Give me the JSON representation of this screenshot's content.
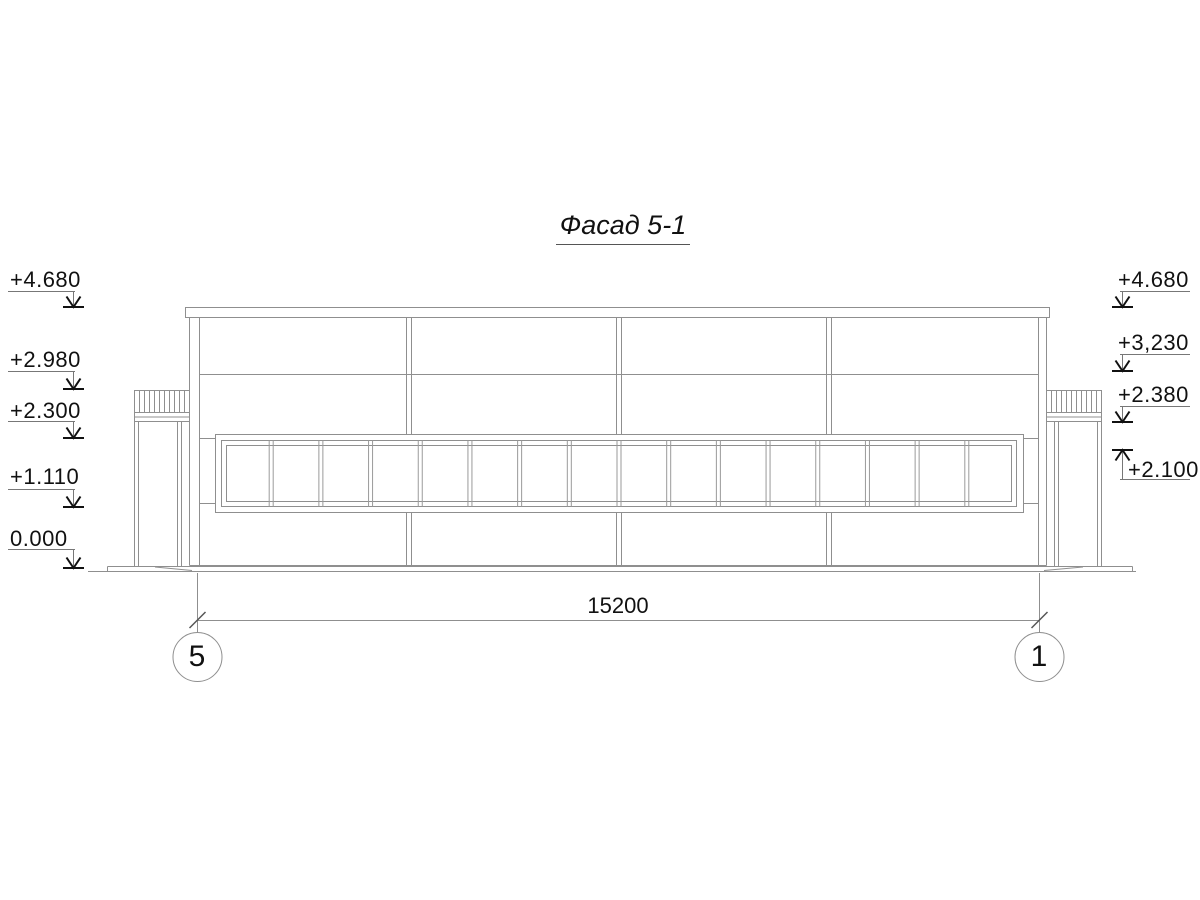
{
  "drawing": {
    "title": "Фасад 5-1",
    "elevation_marks_left": [
      {
        "value": "+4.680"
      },
      {
        "value": "+2.980"
      },
      {
        "value": "+2.300"
      },
      {
        "value": "+1.110"
      },
      {
        "value": "0.000"
      }
    ],
    "elevation_marks_right": [
      {
        "value": "+4.680"
      },
      {
        "value": "+3,230"
      },
      {
        "value": "+2.380"
      },
      {
        "value": "+2.100"
      }
    ],
    "dimension_total": "15200",
    "axis_left_label": "5",
    "axis_right_label": "1",
    "window": {
      "pane_count": 16
    },
    "colors": {
      "thin_line": "#8f8f8f",
      "medium_line": "#6e6e6e",
      "mullion_line": "#9a9a9a",
      "arrow_and_text": "#111111",
      "background": "#ffffff"
    }
  }
}
